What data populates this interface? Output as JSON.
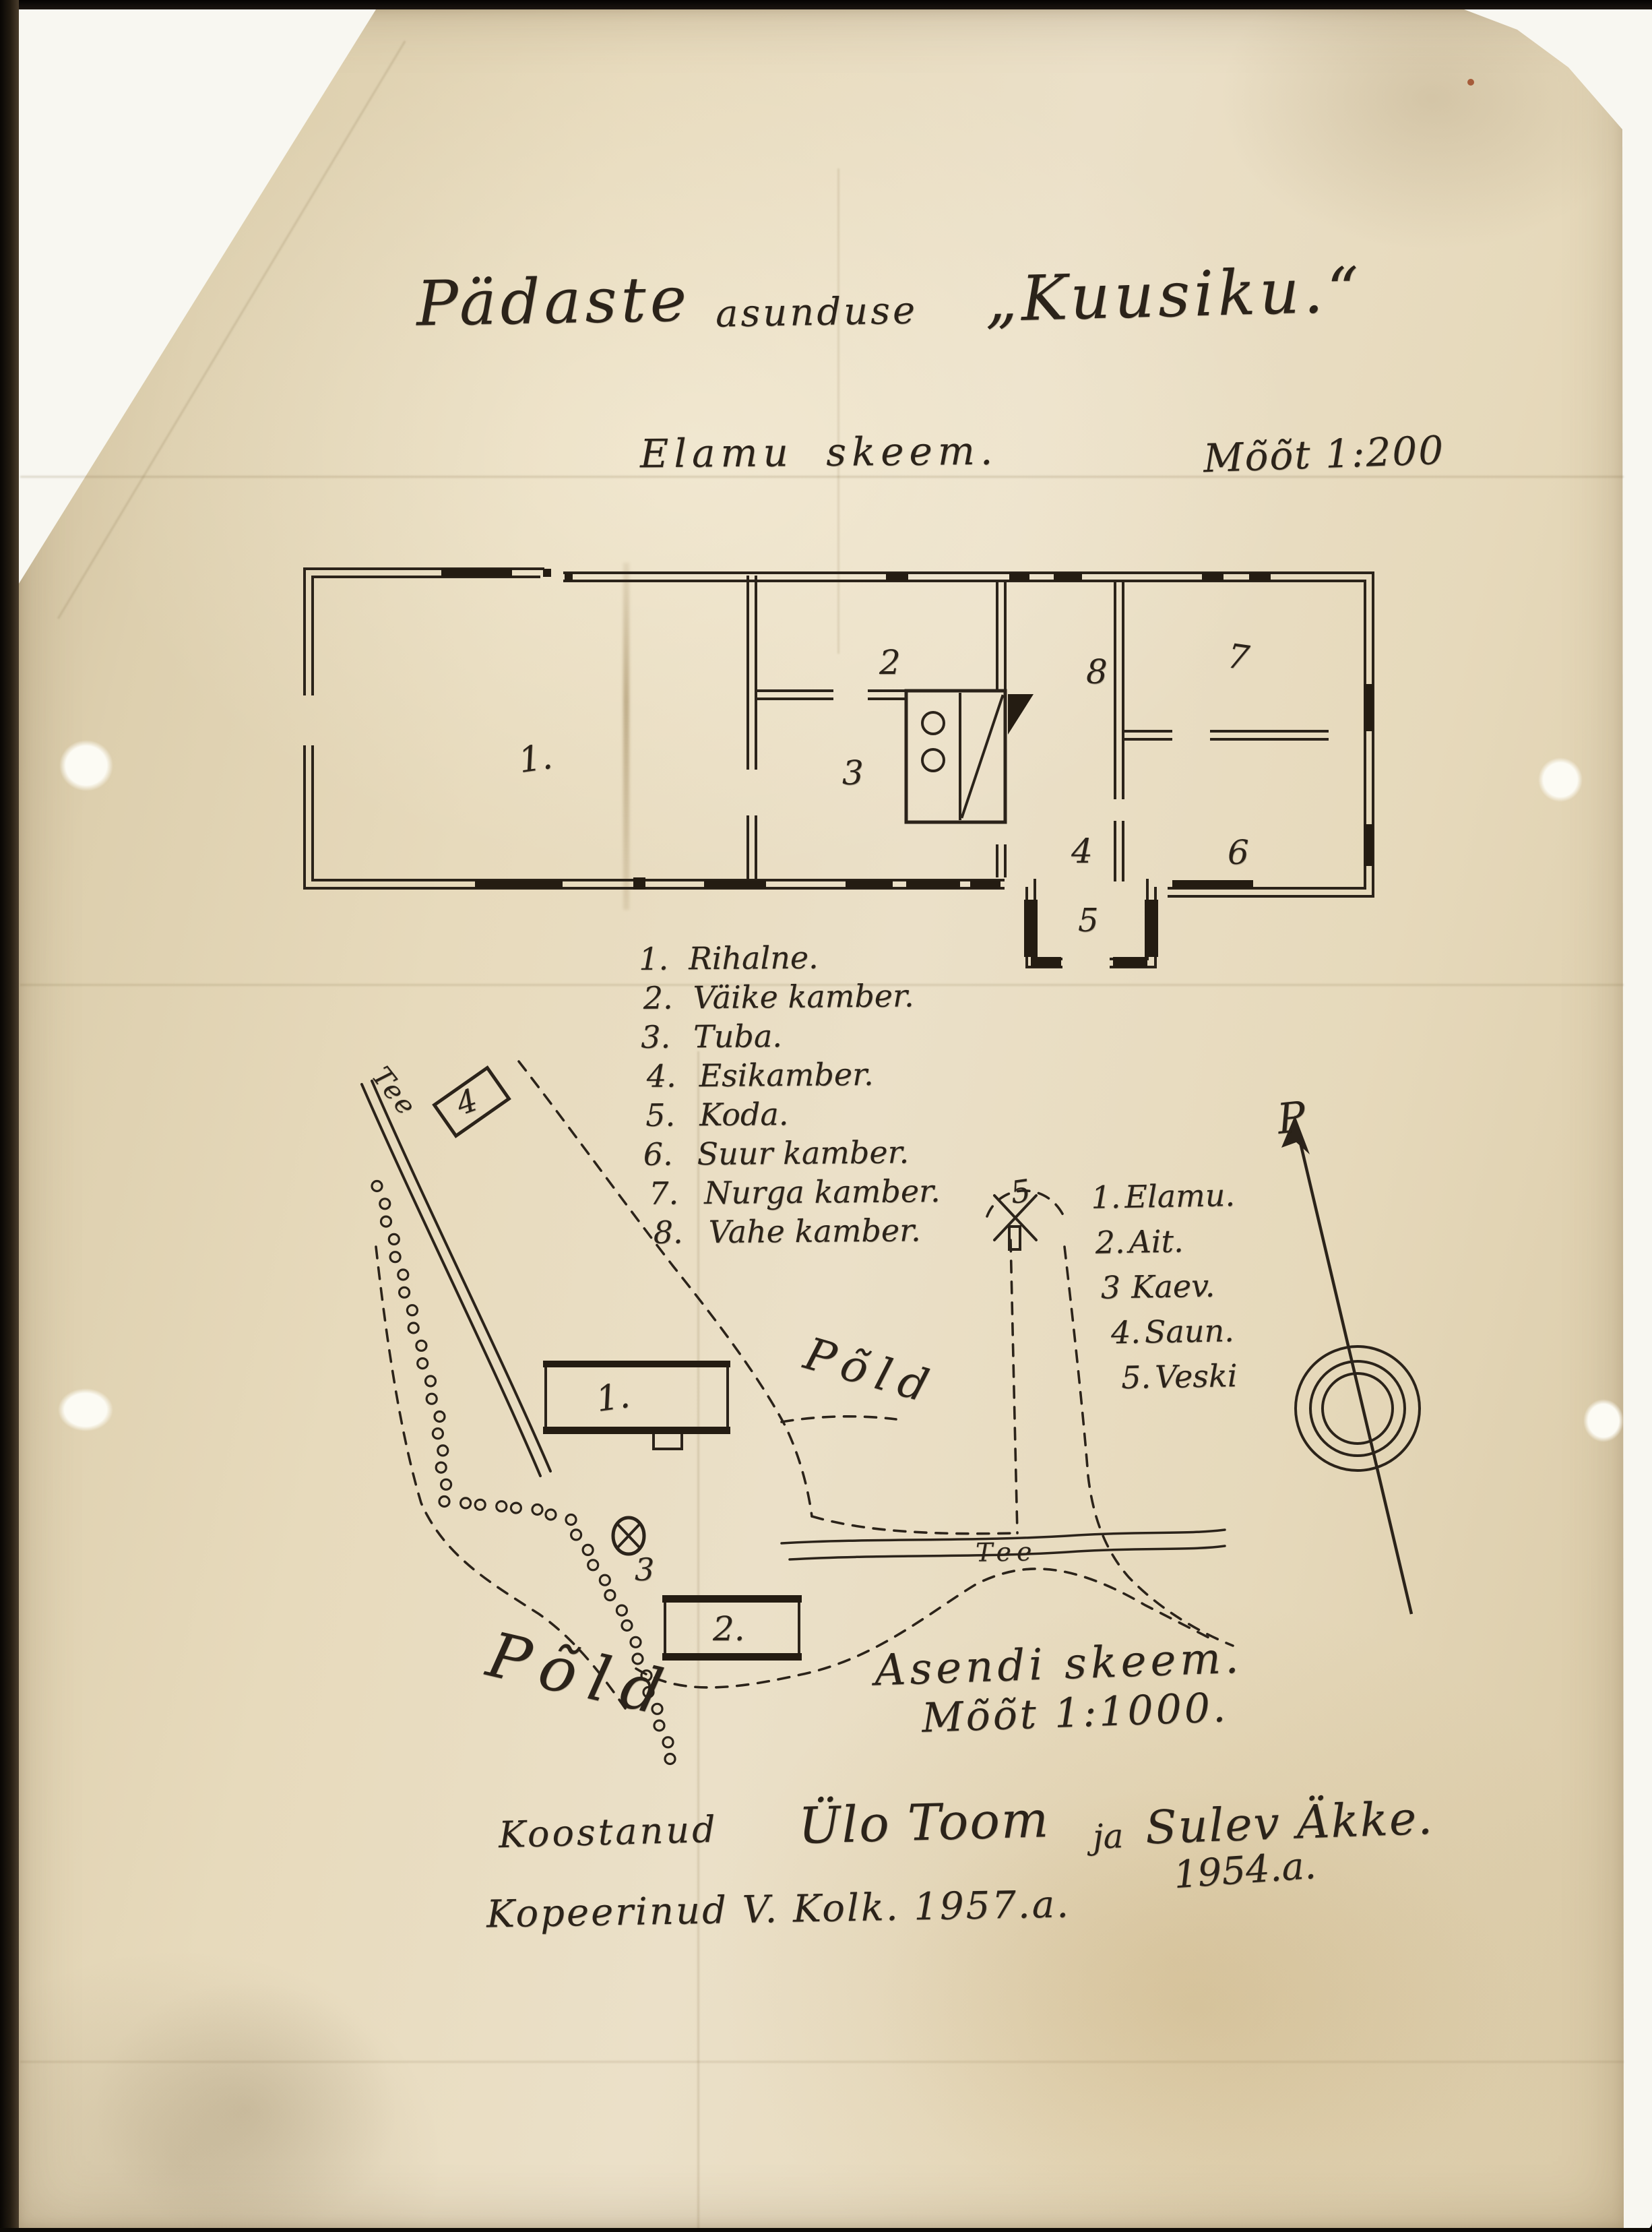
{
  "title": {
    "word1": "Pädaste",
    "word2": "asunduse",
    "word3": "„Kuusiku.“"
  },
  "house_plan": {
    "caption": "Elamu skeem.",
    "scale": "Mõõt 1:200",
    "room_numbers": [
      "1.",
      "2",
      "3",
      "8",
      "7",
      "6",
      "4",
      "5"
    ],
    "legend": [
      {
        "num": "1.",
        "name": "Rihalne."
      },
      {
        "num": "2.",
        "name": "Väike kamber."
      },
      {
        "num": "3.",
        "name": "Tuba."
      },
      {
        "num": "4.",
        "name": "Esikamber."
      },
      {
        "num": "5.",
        "name": "Koda."
      },
      {
        "num": "6.",
        "name": "Suur kamber."
      },
      {
        "num": "7.",
        "name": "Nurga kamber."
      },
      {
        "num": "8.",
        "name": "Vahe kamber."
      }
    ]
  },
  "site_plan": {
    "caption": "Asendi skeem.",
    "scale": "Mõõt 1:1000.",
    "legend": [
      {
        "num": "1.",
        "name": "Elamu."
      },
      {
        "num": "2.",
        "name": "Ait."
      },
      {
        "num": "3",
        "name": "Kaev."
      },
      {
        "num": "4.",
        "name": "Saun."
      },
      {
        "num": "5.",
        "name": "Veski"
      }
    ],
    "labels": {
      "road_upper": "Tee",
      "road_lower": "Tee",
      "field_upper": "Põld",
      "field_lower": "Põld",
      "north": "P"
    },
    "markers": {
      "house": "1.",
      "barn": "2.",
      "well": "3",
      "sauna": "4",
      "mill": "5"
    }
  },
  "credits": {
    "made_by_prefix": "Koostanud",
    "author1": "Ülo Toom",
    "conjunction": "ja",
    "author2": "Sulev Äkke.",
    "year": "1954.a.",
    "copied_line": "Kopeerinud V. Kolk. 1957.a."
  }
}
